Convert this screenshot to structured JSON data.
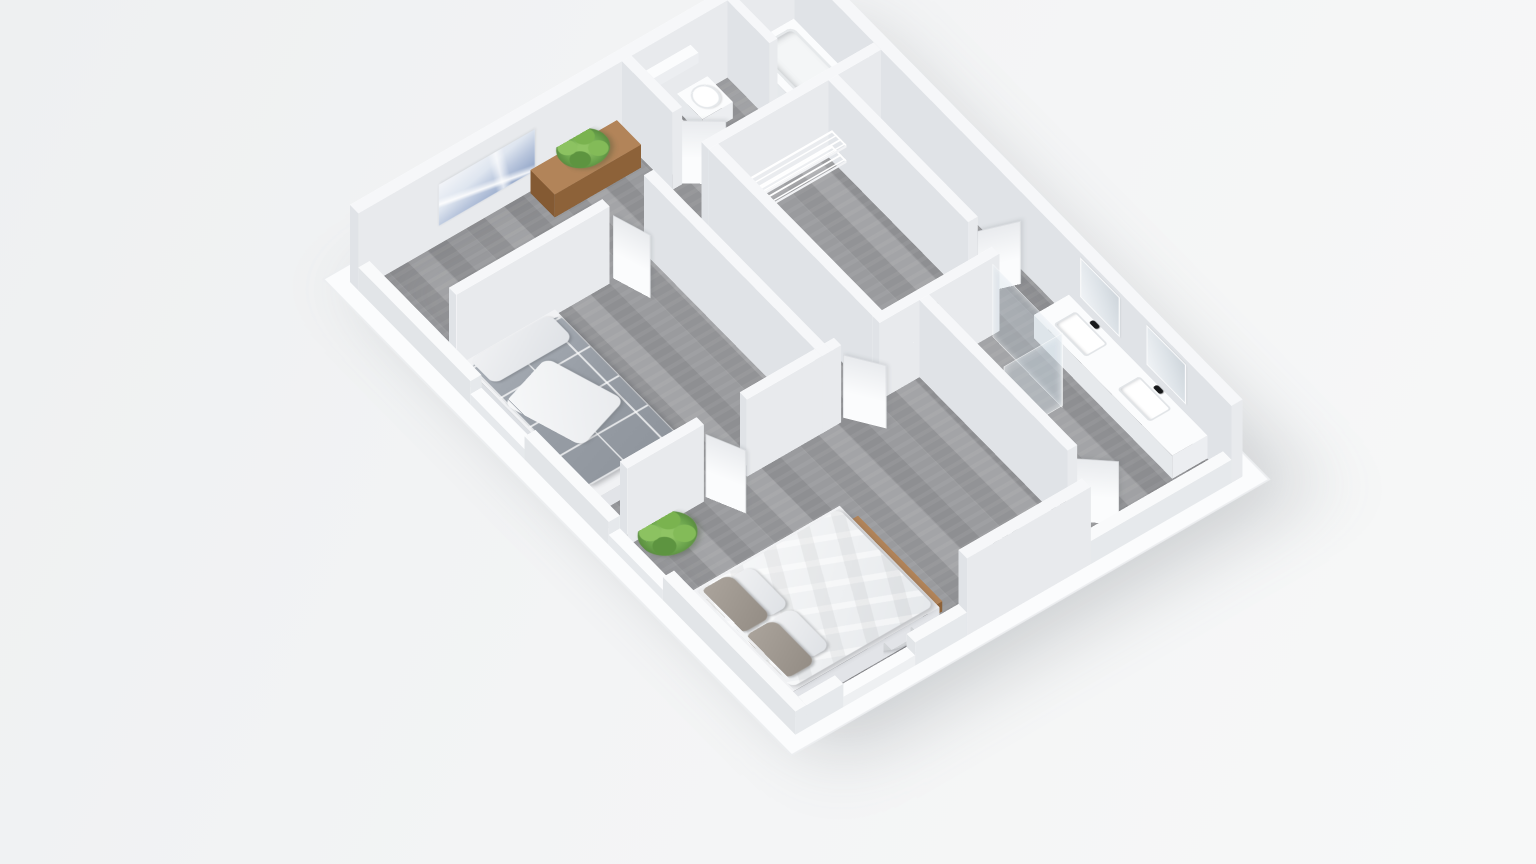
{
  "scene": {
    "description": "isometric-3d-floor-plan-render",
    "colors": {
      "background": "#f1f2f4",
      "base_plate": "#fbfcfd",
      "wall_white": "#f6f7f9",
      "wall_shadow": "#e6e9ec",
      "floor_gray": "#98999c",
      "wood_brown": "#b28459",
      "plant_green": "#6aa34c",
      "textile_gray": "#9ba1a9",
      "duvet_white": "#f4f5f7",
      "tv_black": "#101214",
      "fixture_black": "#17181a",
      "glass_tint": "rgba(205,220,228,0.30)"
    },
    "projection": {
      "rotate_x_deg": 40,
      "rotate_z_deg": -37,
      "origin_left_px": 350,
      "origin_top_px": 282
    },
    "items": [
      {
        "t": "base",
        "name": "base-plate",
        "cls": "base",
        "x": -18,
        "y": -18,
        "w": 596,
        "d": 776
      },
      {
        "t": "flat",
        "name": "floor",
        "cls": "floor-wood",
        "x": 14,
        "y": 14,
        "w": 532,
        "d": 712
      },
      {
        "t": "box",
        "name": "wall-nw",
        "cls": "wall",
        "x": 0,
        "y": 0,
        "w": 560,
        "d": 14,
        "h": 120
      },
      {
        "t": "vplane",
        "name": "wall-art-print",
        "cls": "art",
        "x": 100,
        "y": 15,
        "len": 120,
        "h": 64,
        "z": 30,
        "a": 0
      },
      {
        "t": "box",
        "name": "wall-ne",
        "cls": "wall",
        "x": 546,
        "y": 14,
        "w": 14,
        "d": 726,
        "h": 120
      },
      {
        "t": "box",
        "name": "bathroom-wall-west",
        "cls": "wall",
        "x": 330,
        "y": 14,
        "w": 12,
        "d": 84,
        "h": 120
      },
      {
        "t": "vplane",
        "name": "bathroom-mirror",
        "cls": "mirror",
        "x": 343,
        "y": 32,
        "len": 58,
        "h": 56,
        "z": 50,
        "a": 90
      },
      {
        "t": "box",
        "name": "bathroom-vanity",
        "cls": "white",
        "x": 342,
        "y": 26,
        "w": 34,
        "d": 70,
        "h": 34
      },
      {
        "t": "flat",
        "name": "bathroom-sink-basin",
        "cls": "basin",
        "x": 347,
        "y": 38,
        "w": 24,
        "d": 40,
        "z": 35
      },
      {
        "t": "flat",
        "name": "bathroom-faucet",
        "cls": "faucet",
        "x": 344,
        "y": 52,
        "w": 5,
        "d": 10,
        "z": 36
      },
      {
        "t": "box",
        "name": "bathroom-wall-cabinet",
        "cls": "white",
        "x": 348,
        "y": 14,
        "w": 68,
        "d": 13,
        "h": 16,
        "z": 68
      },
      {
        "t": "box",
        "name": "toilet-body",
        "cls": "white",
        "x": 396,
        "y": 18,
        "w": 38,
        "d": 42,
        "h": 26
      },
      {
        "t": "flat",
        "name": "toilet-seat",
        "cls": "seat",
        "x": 401,
        "y": 24,
        "w": 28,
        "d": 32,
        "z": 29
      },
      {
        "t": "box",
        "name": "bathroom-divider-wall",
        "cls": "wall",
        "x": 462,
        "y": 14,
        "w": 10,
        "d": 70,
        "h": 120
      },
      {
        "t": "box",
        "name": "bathtub",
        "cls": "white",
        "x": 478,
        "y": 18,
        "w": 64,
        "d": 122,
        "h": 38
      },
      {
        "t": "flat",
        "name": "bathtub-basin",
        "cls": "tub-inner",
        "x": 486,
        "y": 26,
        "w": 48,
        "d": 102,
        "z": 39
      },
      {
        "t": "box",
        "name": "bathroom-wall-south",
        "cls": "wall",
        "x": 330,
        "y": 146,
        "w": 216,
        "d": 12,
        "h": 120
      },
      {
        "t": "vplane",
        "name": "bathroom-door",
        "cls": "door",
        "x": 338,
        "y": 100,
        "len": 46,
        "h": 104,
        "a": 38
      },
      {
        "t": "box",
        "name": "console-table",
        "cls": "wood",
        "x": 214,
        "y": 16,
        "w": 108,
        "d": 40,
        "h": 36
      },
      {
        "t": "flat",
        "name": "console-plant-pot",
        "cls": "pot",
        "x": 256,
        "y": 28,
        "w": 16,
        "d": 14,
        "z": 37
      },
      {
        "t": "flat",
        "name": "console-plant",
        "cls": "plant",
        "x": 236,
        "y": 12,
        "w": 56,
        "d": 50,
        "z": 54
      },
      {
        "t": "box",
        "name": "bedroom2-wall-north",
        "cls": "wall",
        "x": 14,
        "y": 146,
        "w": 192,
        "d": 12,
        "h": 120
      },
      {
        "t": "vplane",
        "name": "bedroom2-door",
        "cls": "door",
        "x": 210,
        "y": 158,
        "len": 46,
        "h": 104,
        "a": 72
      },
      {
        "t": "box",
        "name": "bedroom2-wall-east",
        "cls": "wall",
        "x": 258,
        "y": 146,
        "w": 12,
        "d": 296,
        "h": 120
      },
      {
        "t": "box",
        "name": "single-bed-frame",
        "cls": "bedframe",
        "x": 14,
        "y": 168,
        "w": 116,
        "d": 222,
        "h": 24
      },
      {
        "t": "flat",
        "name": "single-bed-duvet",
        "cls": "duvet-plaid",
        "x": 16,
        "y": 178,
        "w": 112,
        "d": 196,
        "z": 26
      },
      {
        "t": "flat",
        "name": "single-bed-throw",
        "cls": "throw",
        "x": 26,
        "y": 224,
        "w": 74,
        "d": 96,
        "z": 27,
        "rot": -18
      },
      {
        "t": "flat",
        "name": "single-bed-pillow",
        "cls": "pillow",
        "x": 20,
        "y": 172,
        "w": 100,
        "d": 40,
        "z": 28
      },
      {
        "t": "box",
        "name": "bedroom2-wall-south-a",
        "cls": "wall",
        "x": 14,
        "y": 430,
        "w": 96,
        "d": 12,
        "h": 120
      },
      {
        "t": "box",
        "name": "bedroom2-wall-south-b",
        "cls": "wall",
        "x": 164,
        "y": 430,
        "w": 94,
        "d": 12,
        "h": 120
      },
      {
        "t": "vplane",
        "name": "bedroom2-door-south",
        "cls": "door",
        "x": 112,
        "y": 442,
        "len": 46,
        "h": 104,
        "a": 65
      },
      {
        "t": "box",
        "name": "closet-wall-west",
        "cls": "wall",
        "x": 330,
        "y": 158,
        "w": 12,
        "d": 272,
        "h": 120
      },
      {
        "t": "box",
        "name": "closet-shelf-north-upper",
        "cls": "shelf-x",
        "x": 346,
        "y": 172,
        "w": 128,
        "d": 24,
        "h": 4,
        "z": 56
      },
      {
        "t": "box",
        "name": "closet-shelf-north-lower",
        "cls": "shelf-x",
        "x": 346,
        "y": 172,
        "w": 128,
        "d": 24,
        "h": 4,
        "z": 32
      },
      {
        "t": "box",
        "name": "closet-shelf-west-upper",
        "cls": "shelf-y",
        "x": 344,
        "y": 202,
        "w": 24,
        "d": 218,
        "h": 4,
        "z": 56
      },
      {
        "t": "box",
        "name": "closet-shelf-west-lower",
        "cls": "shelf-y",
        "x": 344,
        "y": 202,
        "w": 24,
        "d": 218,
        "h": 4,
        "z": 32
      },
      {
        "t": "box",
        "name": "closet-wall-east",
        "cls": "wall",
        "x": 480,
        "y": 158,
        "w": 12,
        "d": 232,
        "h": 120
      },
      {
        "t": "vplane",
        "name": "closet-door",
        "cls": "door",
        "x": 488,
        "y": 394,
        "len": 46,
        "h": 104,
        "a": 20
      },
      {
        "t": "box",
        "name": "central-wall-a",
        "cls": "wall",
        "x": 258,
        "y": 430,
        "w": 24,
        "d": 12,
        "h": 120
      },
      {
        "t": "box",
        "name": "central-wall-b",
        "cls": "wall",
        "x": 330,
        "y": 430,
        "w": 150,
        "d": 12,
        "h": 120
      },
      {
        "t": "vplane",
        "name": "hall-master-door",
        "cls": "door",
        "x": 284,
        "y": 442,
        "len": 46,
        "h": 104,
        "a": 55
      },
      {
        "t": "box",
        "name": "ensuite-wall-west",
        "cls": "wall",
        "x": 380,
        "y": 442,
        "w": 12,
        "d": 246,
        "h": 120
      },
      {
        "t": "vplane",
        "name": "ensuite-door",
        "cls": "door",
        "x": 388,
        "y": 690,
        "len": 44,
        "h": 104,
        "a": 42
      },
      {
        "t": "vplane",
        "name": "shower-glass-side",
        "cls": "glass",
        "x": 470,
        "y": 444,
        "len": 114,
        "h": 112,
        "a": 90
      },
      {
        "t": "vplane",
        "name": "shower-glass-front",
        "cls": "glass",
        "x": 398,
        "y": 558,
        "len": 72,
        "h": 112,
        "a": 0
      },
      {
        "t": "vplane",
        "name": "shower-fixture",
        "cls": "fixture",
        "x": 394,
        "y": 452,
        "len": 3,
        "h": 116,
        "a": 90
      },
      {
        "t": "box",
        "name": "ensuite-double-vanity",
        "cls": "white",
        "x": 502,
        "y": 470,
        "w": 44,
        "d": 230,
        "h": 36
      },
      {
        "t": "flat",
        "name": "ensuite-basin-1",
        "cls": "basin",
        "x": 510,
        "y": 492,
        "w": 28,
        "d": 54,
        "z": 37
      },
      {
        "t": "flat",
        "name": "ensuite-basin-2",
        "cls": "basin",
        "x": 510,
        "y": 598,
        "w": 28,
        "d": 54,
        "z": 37
      },
      {
        "t": "flat",
        "name": "ensuite-faucet-1",
        "cls": "faucet",
        "x": 539,
        "y": 512,
        "w": 6,
        "d": 12,
        "z": 38
      },
      {
        "t": "flat",
        "name": "ensuite-faucet-2",
        "cls": "faucet",
        "x": 539,
        "y": 618,
        "w": 6,
        "d": 12,
        "z": 38
      },
      {
        "t": "vplane",
        "name": "ensuite-mirror-1",
        "cls": "mirror",
        "x": 545,
        "y": 490,
        "len": 62,
        "h": 58,
        "z": 52,
        "a": 90
      },
      {
        "t": "vplane",
        "name": "ensuite-mirror-2",
        "cls": "mirror",
        "x": 545,
        "y": 600,
        "len": 62,
        "h": 58,
        "z": 52,
        "a": 90
      },
      {
        "t": "box",
        "name": "double-bed-frame",
        "cls": "bedframe",
        "x": 14,
        "y": 548,
        "w": 186,
        "d": 166,
        "h": 30
      },
      {
        "t": "flat",
        "name": "double-bed-duvet",
        "cls": "duvet-white",
        "x": 18,
        "y": 552,
        "w": 178,
        "d": 158,
        "z": 32
      },
      {
        "t": "flat",
        "name": "double-bed-pillow-1",
        "cls": "pillow-gray",
        "x": 18,
        "y": 556,
        "w": 38,
        "d": 70,
        "z": 35
      },
      {
        "t": "flat",
        "name": "double-bed-pillow-2",
        "cls": "pillow-gray",
        "x": 18,
        "y": 630,
        "w": 38,
        "d": 70,
        "z": 35
      },
      {
        "t": "flat",
        "name": "double-bed-pillow-3",
        "cls": "pillow",
        "x": 52,
        "y": 560,
        "w": 28,
        "d": 64,
        "z": 34
      },
      {
        "t": "flat",
        "name": "double-bed-pillow-4",
        "cls": "pillow",
        "x": 52,
        "y": 628,
        "w": 28,
        "d": 64,
        "z": 34
      },
      {
        "t": "box",
        "name": "bed-foot-bench",
        "cls": "wood",
        "x": 202,
        "y": 560,
        "w": 12,
        "d": 140,
        "h": 16
      },
      {
        "t": "flat",
        "name": "floor-plant-pot",
        "cls": "pot",
        "x": 36,
        "y": 458,
        "w": 20,
        "d": 18,
        "z": 2
      },
      {
        "t": "flat",
        "name": "floor-plant",
        "cls": "plant",
        "x": 14,
        "y": 440,
        "w": 62,
        "d": 56,
        "z": 22
      },
      {
        "t": "flat",
        "name": "armchair-base",
        "cls": "chair-base",
        "x": 114,
        "y": 652,
        "w": 78,
        "d": 70,
        "z": 14
      },
      {
        "t": "flat",
        "name": "armchair-seat",
        "cls": "chair-seat",
        "x": 126,
        "y": 664,
        "w": 54,
        "d": 48,
        "z": 20
      },
      {
        "t": "box",
        "name": "wall-sw-1",
        "cls": "wall-low",
        "x": 0,
        "y": 14,
        "w": 14,
        "d": 186,
        "h": 36
      },
      {
        "t": "box",
        "name": "window-sill-sw-1",
        "cls": "sill",
        "x": 0,
        "y": 200,
        "w": 14,
        "d": 90,
        "h": 16
      },
      {
        "t": "box",
        "name": "wall-sw-2",
        "cls": "wall-low",
        "x": 0,
        "y": 290,
        "w": 14,
        "d": 140,
        "h": 36
      },
      {
        "t": "box",
        "name": "window-sill-sw-2",
        "cls": "sill",
        "x": 0,
        "y": 430,
        "w": 14,
        "d": 90,
        "h": 16
      },
      {
        "t": "box",
        "name": "wall-sw-3",
        "cls": "wall-low",
        "x": 0,
        "y": 520,
        "w": 14,
        "d": 220,
        "h": 36
      },
      {
        "t": "box",
        "name": "wall-se-1",
        "cls": "wall-low",
        "x": 14,
        "y": 726,
        "w": 46,
        "d": 14,
        "h": 36
      },
      {
        "t": "box",
        "name": "window-sill-se",
        "cls": "sill",
        "x": 60,
        "y": 726,
        "w": 90,
        "d": 14,
        "h": 16
      },
      {
        "t": "box",
        "name": "wall-se-2",
        "cls": "wall-low",
        "x": 150,
        "y": 726,
        "w": 65,
        "d": 14,
        "h": 36
      },
      {
        "t": "box",
        "name": "media-wall",
        "cls": "wall",
        "x": 215,
        "y": 726,
        "w": 155,
        "d": 14,
        "h": 120
      },
      {
        "t": "vplane",
        "name": "tv-screen",
        "cls": "tv",
        "x": 245,
        "y": 725,
        "len": 102,
        "h": 60,
        "z": 34,
        "a": 0
      },
      {
        "t": "box",
        "name": "wall-se-3",
        "cls": "wall-low",
        "x": 370,
        "y": 726,
        "w": 176,
        "d": 14,
        "h": 36
      }
    ]
  }
}
